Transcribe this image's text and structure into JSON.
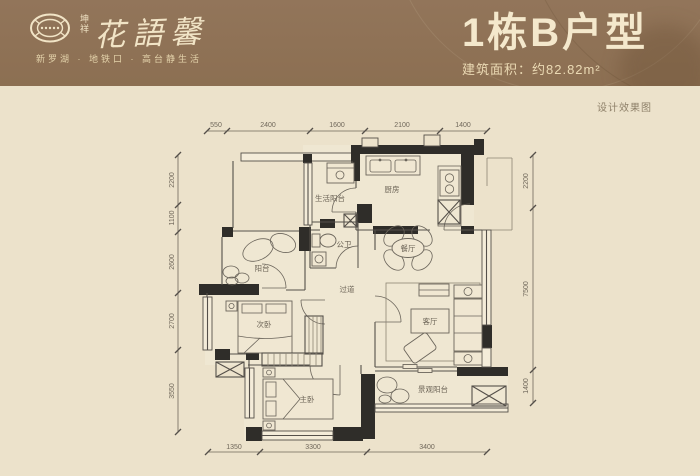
{
  "header": {
    "brand_vertical_1": "坤",
    "brand_vertical_2": "祥",
    "brand_name": "花語馨",
    "tagline": "新罗湖 · 地铁口 · 高台静生活",
    "unit_title": "1栋B户型",
    "area_text": "建筑面积：约82.82m²"
  },
  "watermark": "设计效果图",
  "floorplan": {
    "rooms": [
      {
        "id": "living-balcony",
        "label": "生活阳台"
      },
      {
        "id": "kitchen",
        "label": "厨房"
      },
      {
        "id": "guest-bath",
        "label": "公卫"
      },
      {
        "id": "dining-room",
        "label": "餐厅"
      },
      {
        "id": "balcony",
        "label": "阳台"
      },
      {
        "id": "corridor",
        "label": "过道"
      },
      {
        "id": "second-bedroom",
        "label": "次卧"
      },
      {
        "id": "living-room",
        "label": "客厅"
      },
      {
        "id": "master-bedroom",
        "label": "主卧"
      },
      {
        "id": "view-balcony",
        "label": "景观阳台"
      }
    ],
    "dimensions": {
      "top": [
        "550",
        "2400",
        "1600",
        "2100",
        "1400"
      ],
      "bottom": [
        "1350",
        "3300",
        "3400"
      ],
      "left": [
        "2200",
        "1100",
        "2600",
        "2700",
        "3550"
      ],
      "right": [
        "2200",
        "7500",
        "1400"
      ]
    }
  },
  "colors": {
    "header_bg": "#8c6f52",
    "header_text": "#f4e8cc",
    "body_bg": "#ece2cb",
    "wall": "#2f2d29",
    "line": "#55504a",
    "dim_text": "#6f675a"
  }
}
